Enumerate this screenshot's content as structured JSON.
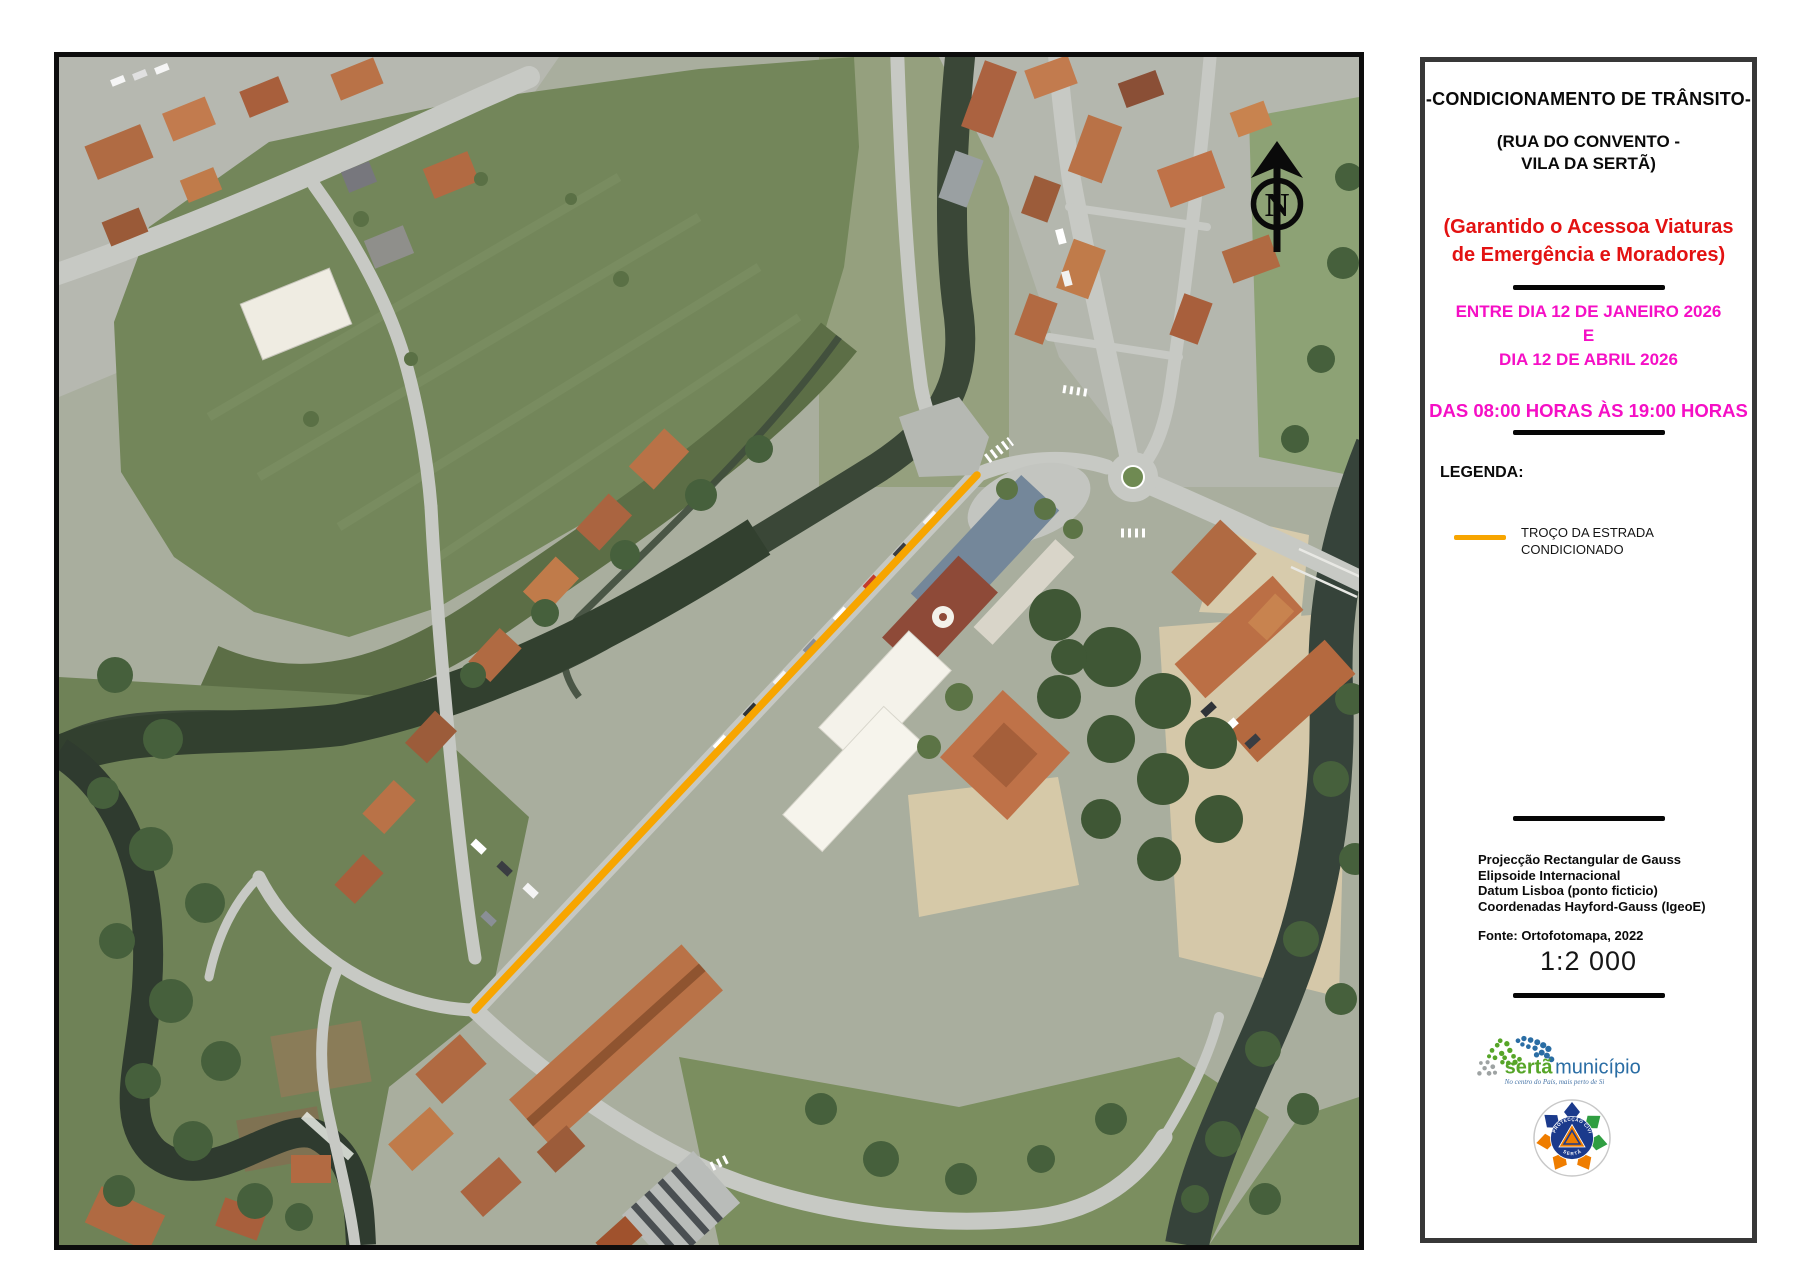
{
  "colors": {
    "magenta": "#F50FC5",
    "red": "#E31212",
    "route_orange": "#F7A500",
    "serta_green": "#56A528",
    "serta_blue": "#2A6DA4",
    "pc_blue": "#1B3A8C",
    "pc_orange": "#EF7D00",
    "pc_green": "#2F9E41"
  },
  "panel": {
    "title": "-CONDICIONAMENTO DE TRÂNSITO-",
    "location_line1": "(RUA DO CONVENTO -",
    "location_line2": "VILA DA SERTÃ)",
    "notice_line1": "(Garantido o Acessoa Viaturas",
    "notice_line2": "de Emergência e Moradores)",
    "period_line1": "ENTRE DIA 12 DE JANEIRO 2026",
    "period_line2": "E",
    "period_line3": "DIA 12 DE ABRIL 2026",
    "hours": "DAS 08:00 HORAS ÀS 19:00 HORAS",
    "legend": {
      "heading": "LEGENDA:",
      "item_line1": "TROÇO DA ESTRADA",
      "item_line2": "CONDICIONADO"
    },
    "projection_lines": [
      "Projecção Rectangular de Gauss",
      "Elipsoide Internacional",
      "Datum Lisboa (ponto ficticio)",
      "Coordenadas Hayford-Gauss (IgeoE)"
    ],
    "source": "Fonte: Ortofotomapa, 2022",
    "scale": "1:2 000",
    "logos": {
      "municipality_part1": "sertã",
      "municipality_part2": "município",
      "municipality_tagline": "No centro do País, mais perto de Si",
      "civil_protection_arc_top": "PROTECÇÃO CIVIL",
      "civil_protection_arc_bottom": "SERTÃ"
    }
  },
  "map": {
    "north_label": "N"
  }
}
